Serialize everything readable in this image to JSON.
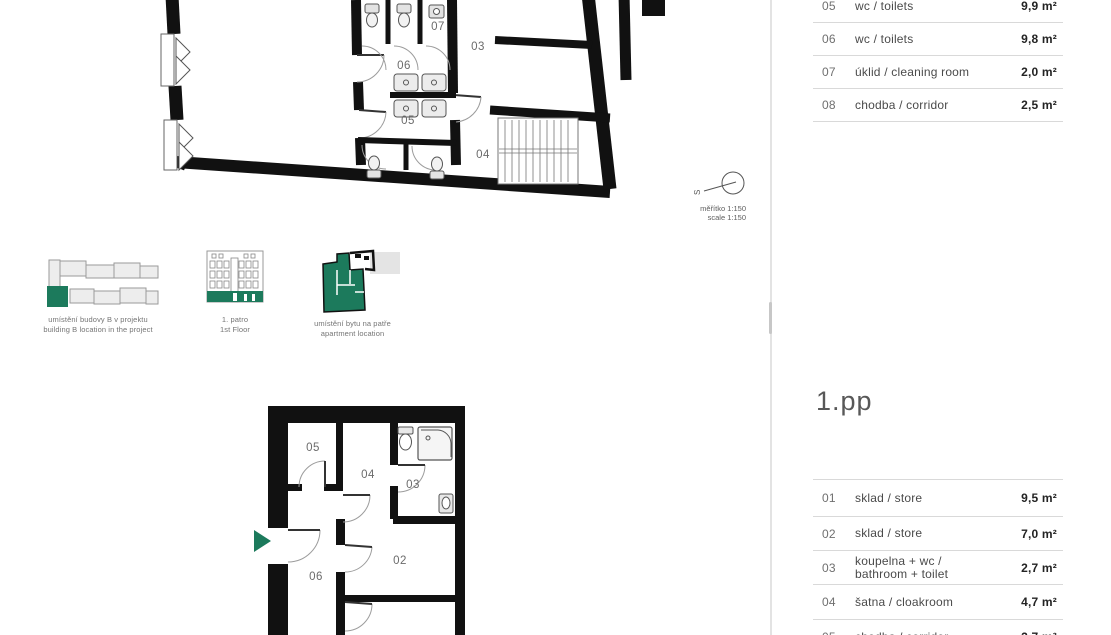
{
  "colors": {
    "accent_green": "#1c7a5c",
    "wall_black": "#111111",
    "divider_gray": "#e3e3e3"
  },
  "upper_plan": {
    "room_labels": [
      "07",
      "03",
      "06",
      "05",
      "04"
    ]
  },
  "lower_plan": {
    "room_labels": [
      "05",
      "04",
      "03",
      "02",
      "06"
    ]
  },
  "scale_indicator": {
    "compass_label": "S",
    "line1": "měřítko 1:150",
    "line2": "scale 1:150"
  },
  "thumbnails": [
    {
      "caption_line1": "umístění budovy B v projektu",
      "caption_line2": "building B location in the project"
    },
    {
      "caption_line1": "1. patro",
      "caption_line2": "1st Floor"
    },
    {
      "caption_line1": "umístění bytu na patře",
      "caption_line2": "apartment location"
    }
  ],
  "upper_table": {
    "rows": [
      {
        "num": "05",
        "name": "wc / toilets",
        "area": "9,9 m²"
      },
      {
        "num": "06",
        "name": "wc / toilets",
        "area": "9,8 m²"
      },
      {
        "num": "07",
        "name": "úklid / cleaning room",
        "area": "2,0 m²"
      },
      {
        "num": "08",
        "name": "chodba / corridor",
        "area": "2,5 m²"
      }
    ]
  },
  "lower_section": {
    "heading": "1.pp",
    "rows": [
      {
        "num": "01",
        "name": "sklad / store",
        "area": "9,5 m²"
      },
      {
        "num": "02",
        "name": "sklad / store",
        "area": "7,0 m²"
      },
      {
        "num": "03",
        "name": "koupelna + wc / bathroom + toilet",
        "area": "2,7 m²"
      },
      {
        "num": "04",
        "name": "šatna / cloakroom",
        "area": "4,7 m²"
      },
      {
        "num": "05",
        "name": "chodba / corridor",
        "area": "2,7 m²"
      }
    ]
  }
}
